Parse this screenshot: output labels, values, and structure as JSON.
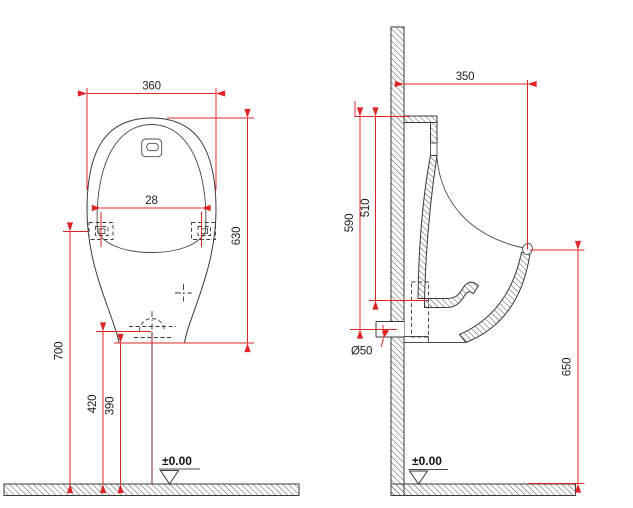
{
  "drawing": {
    "front_view": {
      "width": "360",
      "mount_holes": "28",
      "height": "630",
      "holes_to_floor": "700",
      "outlet_to_floor": "420",
      "bottom_to_floor": "390",
      "datum": "±0.00"
    },
    "side_view": {
      "depth": "350",
      "top_to_outlet": "590",
      "top_to_bowl_bottom": "510",
      "outlet_diameter": "Ø50",
      "rim_to_floor": "650",
      "datum": "±0.00"
    },
    "colors": {
      "dimension_red": "#e02529",
      "centerline_dark_red": "#963434",
      "line_black": "#3a3a3a"
    }
  }
}
